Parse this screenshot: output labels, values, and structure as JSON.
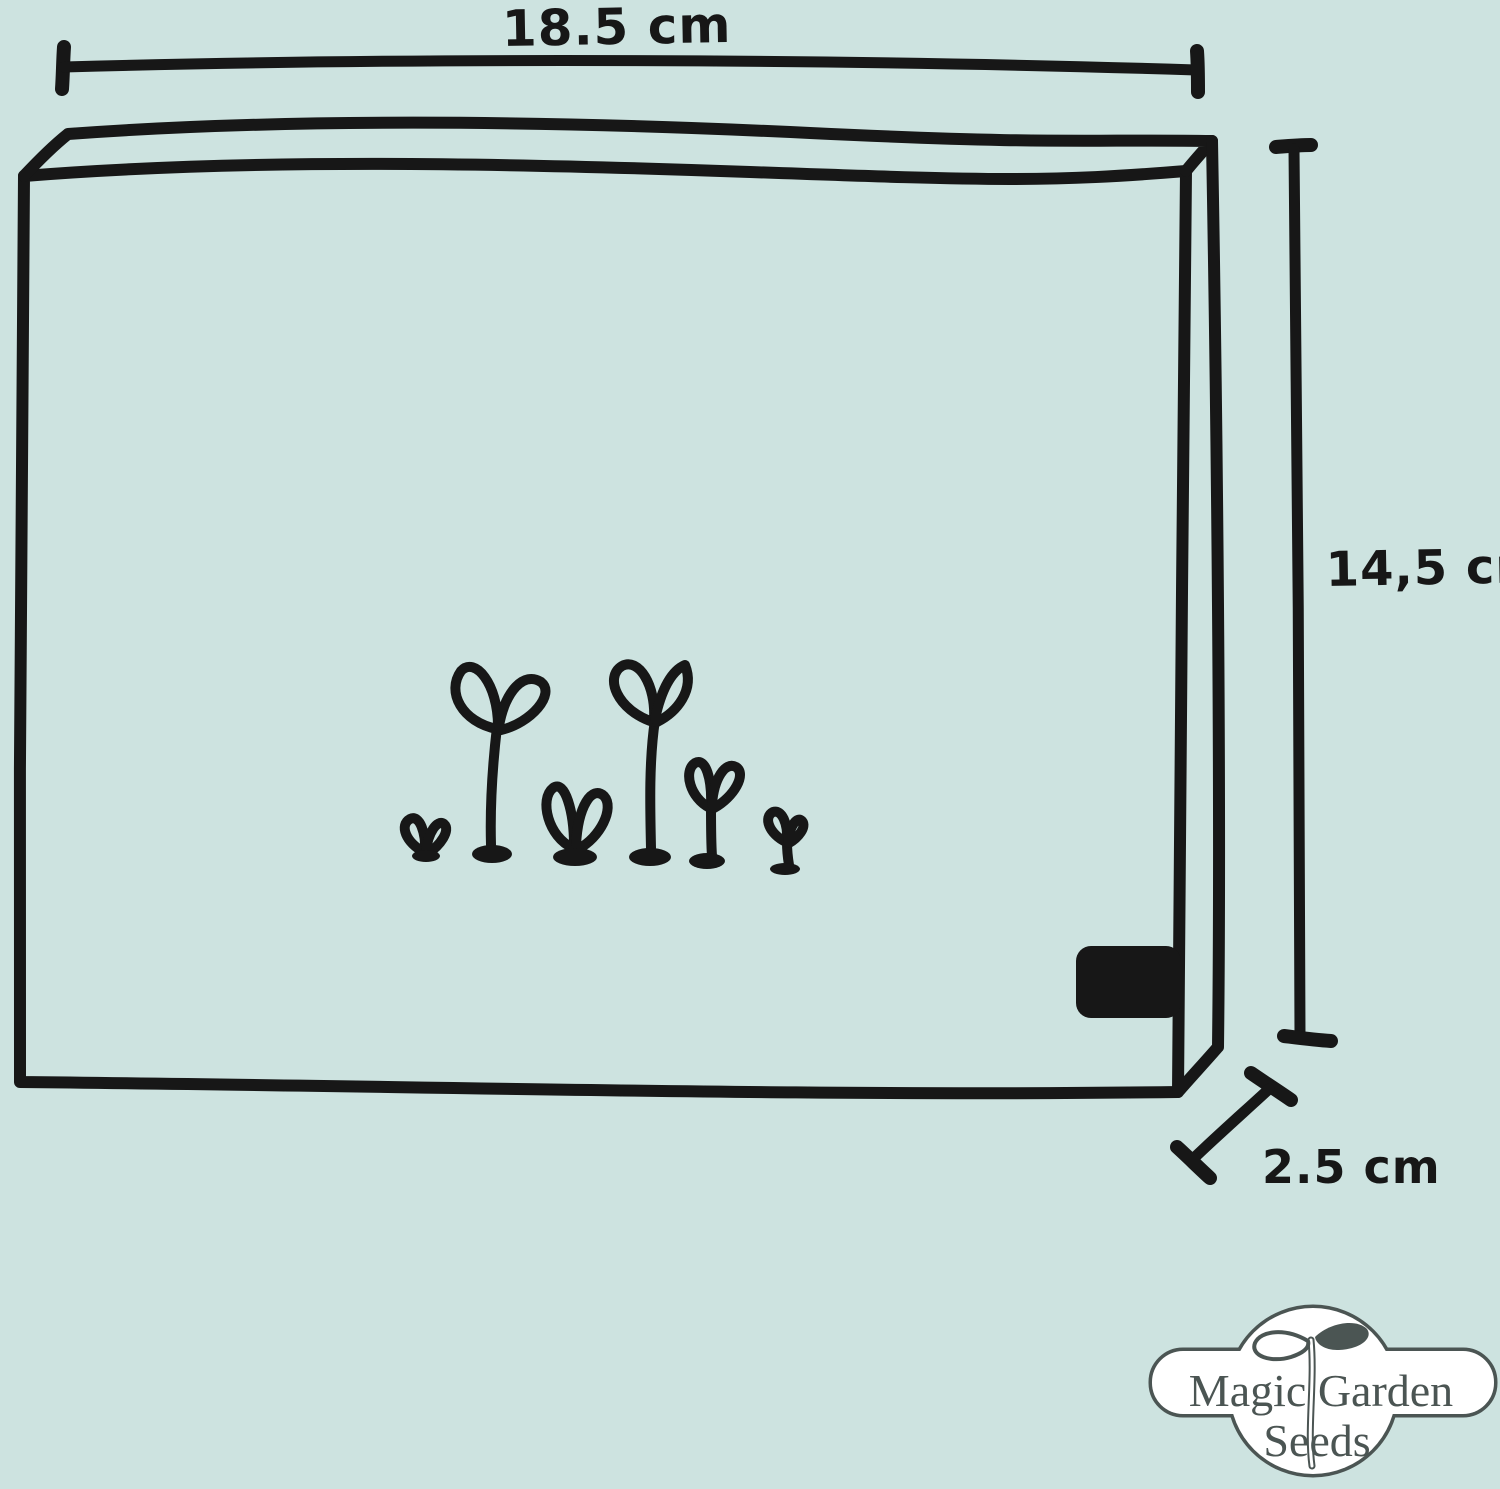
{
  "canvas": {
    "background_color": "#cde3e0",
    "ink_color": "#171717"
  },
  "dimensions": {
    "width_label": "18.5 cm",
    "height_label": "14,5 cm",
    "depth_label": "2.5 cm"
  },
  "illustration": {
    "subject": "seed box with sprouts",
    "sprout_count": 6
  },
  "logo": {
    "text_top": "Magic Garden",
    "text_bottom": "Seeds",
    "color": "#4b5553"
  }
}
